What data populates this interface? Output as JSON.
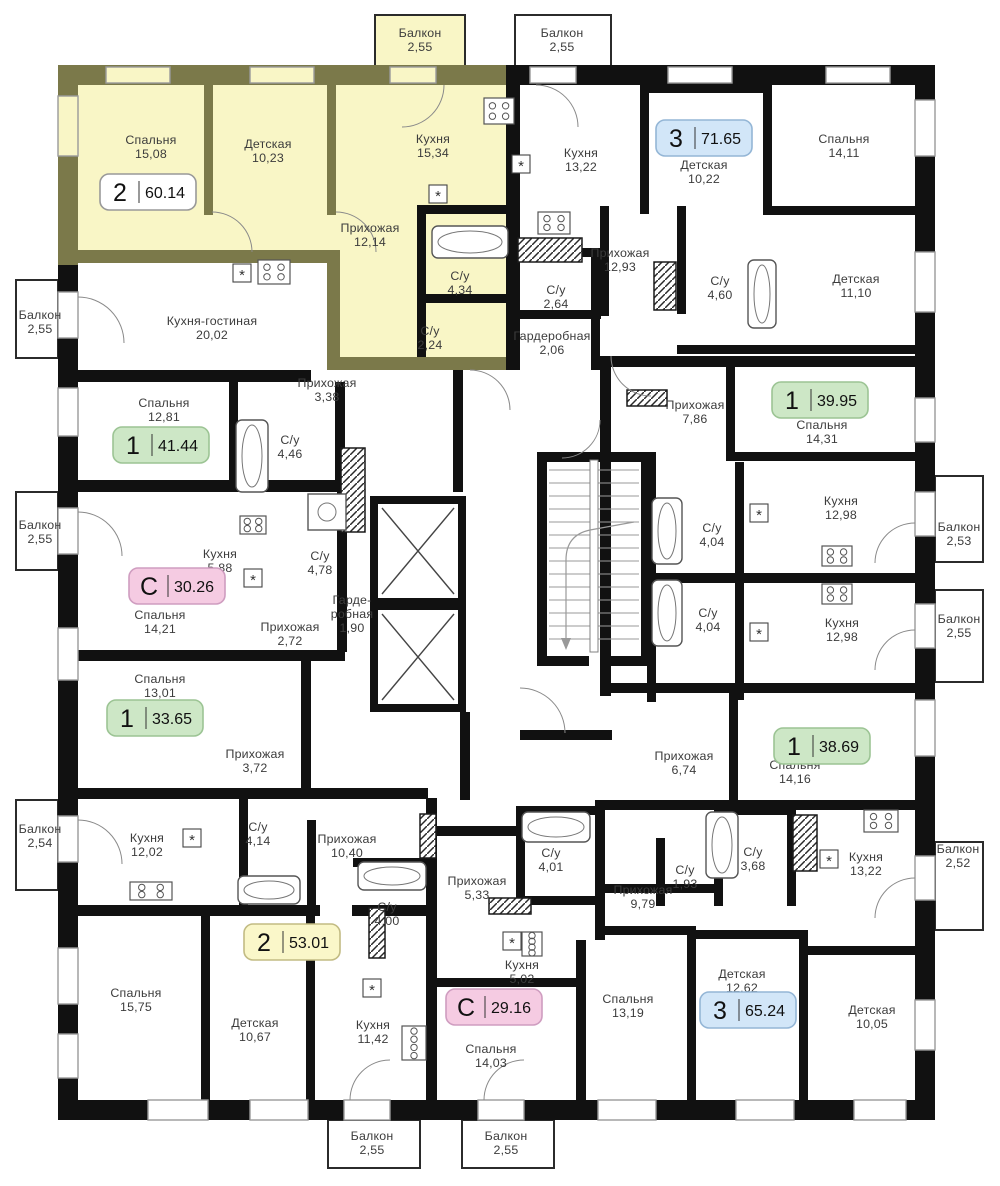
{
  "colors": {
    "highlight_fill": "#f9f6c6",
    "highlight_wall": "#7b794a",
    "wall": "#111111",
    "badge_palette": {
      "white": {
        "bg": "#ffffff",
        "border": "#999999"
      },
      "blue": {
        "bg": "#d2e6f8",
        "border": "#94b6d6"
      },
      "green": {
        "bg": "#cde7c6",
        "border": "#9cc494"
      },
      "pink": {
        "bg": "#f5cbe2",
        "border": "#cf9dc0"
      },
      "yellow": {
        "bg": "#faf7c9",
        "border": "#c2bb83"
      }
    }
  },
  "apartments": [
    {
      "id": "apt-2-60-14",
      "highlighted": true,
      "badge": {
        "type": "2",
        "area": "60.14",
        "color": "white",
        "x": 148,
        "y": 192
      },
      "rooms": [
        {
          "label": "Спальня",
          "area": "15,08",
          "x": 151,
          "y": 147
        },
        {
          "label": "Детская",
          "area": "10,23",
          "x": 268,
          "y": 151
        },
        {
          "label": "Кухня",
          "area": "15,34",
          "x": 433,
          "y": 146
        },
        {
          "label": "Прихожая",
          "area": "12,14",
          "x": 370,
          "y": 235
        },
        {
          "label": "С/у",
          "area": "4,34",
          "x": 460,
          "y": 283
        },
        {
          "label": "С/у",
          "area": "2,24",
          "x": 430,
          "y": 338
        },
        {
          "label": "Балкон",
          "area": "2,55",
          "x": 420,
          "y": 40
        }
      ]
    },
    {
      "id": "apt-3-71-65",
      "badge": {
        "type": "3",
        "area": "71.65",
        "color": "blue",
        "x": 704,
        "y": 138
      },
      "rooms": [
        {
          "label": "Кухня",
          "area": "13,22",
          "x": 581,
          "y": 160
        },
        {
          "label": "Детская",
          "area": "10,22",
          "x": 704,
          "y": 172
        },
        {
          "label": "Спальня",
          "area": "14,11",
          "x": 844,
          "y": 146
        },
        {
          "label": "Прихожая",
          "area": "12,93",
          "x": 620,
          "y": 260
        },
        {
          "label": "С/у",
          "area": "4,60",
          "x": 720,
          "y": 288
        },
        {
          "label": "С/у",
          "area": "2,64",
          "x": 556,
          "y": 297
        },
        {
          "label": "Гардеробная",
          "area": "2,06",
          "x": 552,
          "y": 343
        },
        {
          "label": "Детская",
          "area": "11,10",
          "x": 856,
          "y": 286
        },
        {
          "label": "Балкон",
          "area": "2,55",
          "x": 562,
          "y": 40
        }
      ]
    },
    {
      "id": "apt-1-41-44",
      "badge": {
        "type": "1",
        "area": "41.44",
        "color": "green",
        "x": 161,
        "y": 445
      },
      "rooms": [
        {
          "label": "Кухня-гостиная",
          "area": "20,02",
          "x": 212,
          "y": 328
        },
        {
          "label": "Спальня",
          "area": "12,81",
          "x": 164,
          "y": 410
        },
        {
          "label": "Прихожая",
          "area": "3,38",
          "x": 327,
          "y": 390
        },
        {
          "label": "С/у",
          "area": "4,46",
          "x": 290,
          "y": 447
        },
        {
          "label": "Балкон",
          "area": "2,55",
          "x": 40,
          "y": 322
        }
      ]
    },
    {
      "id": "apt-c-30-26",
      "badge": {
        "type": "С",
        "area": "30.26",
        "color": "pink",
        "x": 177,
        "y": 586
      },
      "rooms": [
        {
          "label": "Кухня",
          "area": "5,88",
          "x": 220,
          "y": 561
        },
        {
          "label": "С/у",
          "area": "4,78",
          "x": 320,
          "y": 563
        },
        {
          "label": "Спальня",
          "area": "14,21",
          "x": 160,
          "y": 622
        },
        {
          "label": "Прихожая",
          "area": "2,72",
          "x": 290,
          "y": 634
        },
        {
          "label": "Гарде-",
          "label2": "робная",
          "area": "1,90",
          "x": 352,
          "y": 614
        },
        {
          "label": "Балкон",
          "area": "2,55",
          "x": 40,
          "y": 532
        }
      ]
    },
    {
      "id": "apt-1-33-65",
      "badge": {
        "type": "1",
        "area": "33.65",
        "color": "green",
        "x": 155,
        "y": 718
      },
      "rooms": [
        {
          "label": "Спальня",
          "area": "13,01",
          "x": 160,
          "y": 686
        },
        {
          "label": "Прихожая",
          "area": "3,72",
          "x": 255,
          "y": 761
        }
      ]
    },
    {
      "id": "apt-2-53-01",
      "badge": {
        "type": "2",
        "area": "53.01",
        "color": "yellow",
        "x": 292,
        "y": 942
      },
      "rooms": [
        {
          "label": "Кухня",
          "area": "12,02",
          "x": 147,
          "y": 845
        },
        {
          "label": "С/у",
          "area": "4,14",
          "x": 258,
          "y": 834
        },
        {
          "label": "Прихожая",
          "area": "10,40",
          "x": 347,
          "y": 846
        },
        {
          "label": "С/у",
          "area": "4,00",
          "x": 387,
          "y": 914
        },
        {
          "label": "Спальня",
          "area": "15,75",
          "x": 136,
          "y": 1000
        },
        {
          "label": "Детская",
          "area": "10,67",
          "x": 255,
          "y": 1030
        },
        {
          "label": "Кухня",
          "area": "11,42",
          "x": 373,
          "y": 1032
        },
        {
          "label": "Балкон",
          "area": "2,54",
          "x": 40,
          "y": 836
        },
        {
          "label": "Балкон",
          "area": "2,55",
          "x": 372,
          "y": 1143
        }
      ]
    },
    {
      "id": "apt-c-29-16",
      "badge": {
        "type": "С",
        "area": "29.16",
        "color": "pink",
        "x": 494,
        "y": 1007
      },
      "rooms": [
        {
          "label": "Прихожая",
          "area": "5,33",
          "x": 477,
          "y": 888
        },
        {
          "label": "С/у",
          "area": "4,01",
          "x": 551,
          "y": 860
        },
        {
          "label": "Кухня",
          "area": "5,02",
          "x": 522,
          "y": 972
        },
        {
          "label": "Спальня",
          "area": "14,03",
          "x": 491,
          "y": 1056
        },
        {
          "label": "Балкон",
          "area": "2,55",
          "x": 506,
          "y": 1143
        }
      ]
    },
    {
      "id": "apt-3-65-24",
      "badge": {
        "type": "3",
        "area": "65.24",
        "color": "blue",
        "x": 748,
        "y": 1010
      },
      "rooms": [
        {
          "label": "Прихожая",
          "area": "9,79",
          "x": 643,
          "y": 897
        },
        {
          "label": "С/у",
          "area": "1,93",
          "x": 685,
          "y": 877
        },
        {
          "label": "С/у",
          "area": "3,68",
          "x": 753,
          "y": 859
        },
        {
          "label": "Кухня",
          "area": "13,22",
          "x": 866,
          "y": 864
        },
        {
          "label": "Спальня",
          "area": "13,19",
          "x": 628,
          "y": 1006
        },
        {
          "label": "Детская",
          "area": "12,62",
          "x": 742,
          "y": 981
        },
        {
          "label": "Детская",
          "area": "10,05",
          "x": 872,
          "y": 1017
        },
        {
          "label": "Балкон",
          "area": "2,52",
          "x": 958,
          "y": 856
        }
      ]
    },
    {
      "id": "apt-1-39-95",
      "badge": {
        "type": "1",
        "area": "39.95",
        "color": "green",
        "x": 820,
        "y": 400
      },
      "rooms": [
        {
          "label": "Прихожая",
          "area": "7,86",
          "x": 695,
          "y": 412
        },
        {
          "label": "Спальня",
          "area": "14,31",
          "x": 822,
          "y": 432
        },
        {
          "label": "С/у",
          "area": "4,04",
          "x": 712,
          "y": 535
        },
        {
          "label": "Кухня",
          "area": "12,98",
          "x": 841,
          "y": 508
        },
        {
          "label": "Балкон",
          "area": "2,53",
          "x": 959,
          "y": 534
        }
      ]
    },
    {
      "id": "apt-1-38-69",
      "badge": {
        "type": "1",
        "area": "38.69",
        "color": "green",
        "x": 822,
        "y": 746
      },
      "rooms": [
        {
          "label": "С/у",
          "area": "4,04",
          "x": 708,
          "y": 620
        },
        {
          "label": "Кухня",
          "area": "12,98",
          "x": 842,
          "y": 630
        },
        {
          "label": "Прихожая",
          "area": "6,74",
          "x": 684,
          "y": 763
        },
        {
          "label": "Спальня",
          "area": "14,16",
          "x": 795,
          "y": 772
        },
        {
          "label": "Балкон",
          "area": "2,55",
          "x": 959,
          "y": 626
        }
      ]
    }
  ],
  "icons": [
    {
      "name": "washer-spot-icon",
      "symbol": "*",
      "x": 438,
      "y": 194
    },
    {
      "name": "washer-spot-icon",
      "symbol": "*",
      "x": 242,
      "y": 273
    },
    {
      "name": "washer-spot-icon",
      "symbol": "*",
      "x": 521,
      "y": 164
    },
    {
      "name": "washer-spot-icon",
      "symbol": "*",
      "x": 759,
      "y": 513
    },
    {
      "name": "washer-spot-icon",
      "symbol": "*",
      "x": 759,
      "y": 632
    },
    {
      "name": "washer-spot-icon",
      "symbol": "*",
      "x": 829,
      "y": 859
    },
    {
      "name": "washer-spot-icon",
      "symbol": "*",
      "x": 192,
      "y": 838
    },
    {
      "name": "washer-spot-icon",
      "symbol": "*",
      "x": 372,
      "y": 988
    },
    {
      "name": "washer-spot-icon",
      "symbol": "*",
      "x": 512,
      "y": 941
    },
    {
      "name": "washer-spot-icon",
      "symbol": "*",
      "x": 253,
      "y": 578
    }
  ]
}
